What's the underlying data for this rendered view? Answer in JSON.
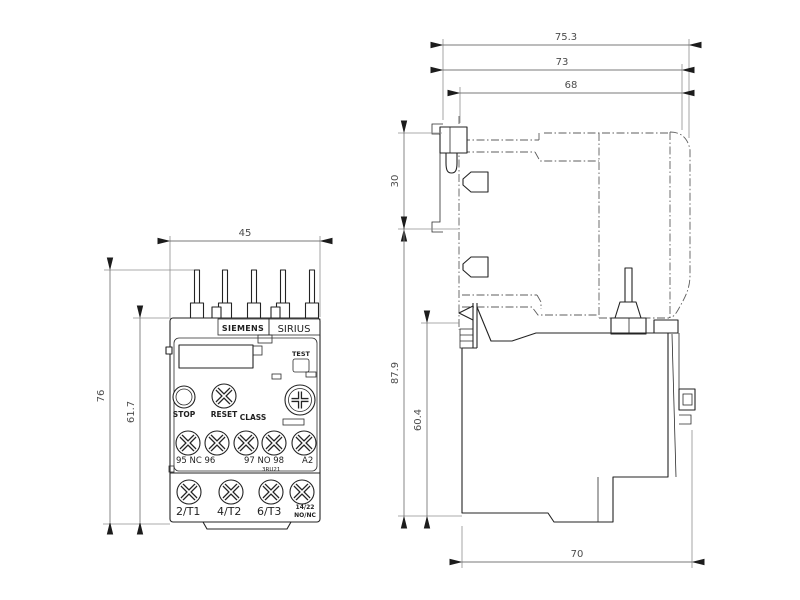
{
  "front_view": {
    "dims": {
      "width": "45",
      "overall_height": "76",
      "body_height": "61.7"
    },
    "labels": {
      "brand": "SIEMENS",
      "series": "SIRIUS",
      "test": "TEST",
      "stop": "STOP",
      "reset": "RESET",
      "class": "CLASS",
      "aux_row_left": "95 NC 96",
      "aux_row_mid": "97 NO 98",
      "aux_row_right": "A2",
      "type": "3RU21",
      "main_t1": "2/T1",
      "main_t2": "4/T2",
      "main_t3": "6/T3",
      "aux_contact_top": "14/22",
      "aux_contact_bottom": "NO/NC"
    }
  },
  "side_view": {
    "dims": {
      "overall_depth": "75.3",
      "mid_depth": "73",
      "inner_depth": "68",
      "top_offset": "30",
      "overall_height": "87.9",
      "body_height": "60.4",
      "bottom_depth": "70"
    }
  },
  "colors": {
    "line": "#232323",
    "dimension": "#7a7a7a",
    "background": "#ffffff"
  }
}
